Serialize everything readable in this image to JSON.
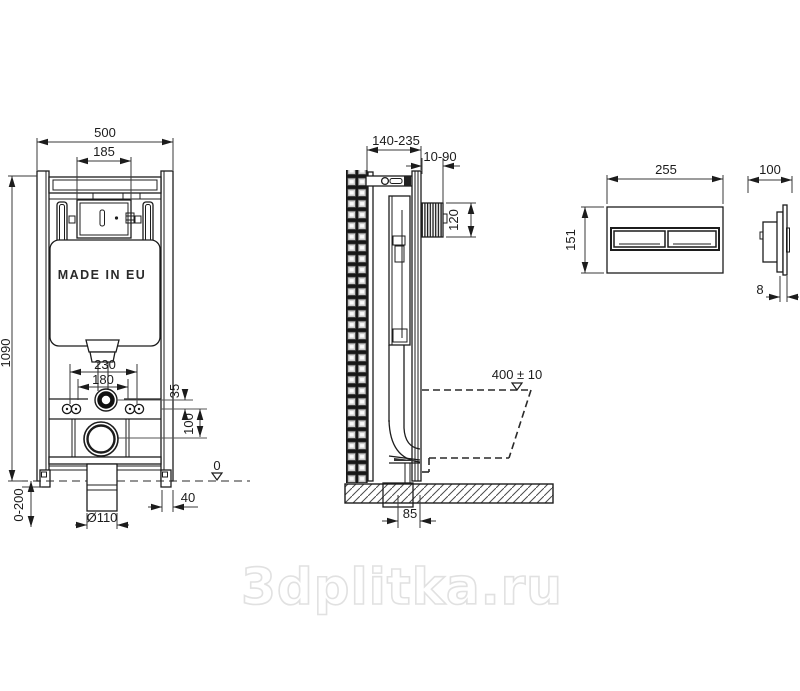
{
  "watermark": "3dplitka.ru",
  "front_view": {
    "made_in": "MADE IN EU",
    "width_total": "500",
    "width_flush_unit": "185",
    "height_frame": "1090",
    "bolt_spacing_outer": "230",
    "bolt_spacing_inner": "180",
    "flush_pipe_offset": "35",
    "drain_offset": "100",
    "floor_level": "0",
    "foot_width": "40",
    "drain_diameter": "Ø110",
    "foot_adjustment": "0-200"
  },
  "side_view": {
    "depth_range": "140-235",
    "recess_depth_range": "10-90",
    "recess_height": "120",
    "bowl_height": "400 ± 10",
    "drain_wall_distance": "85"
  },
  "flush_plate": {
    "width": "255",
    "height": "151",
    "depth": "100",
    "flange_thickness": "8"
  }
}
